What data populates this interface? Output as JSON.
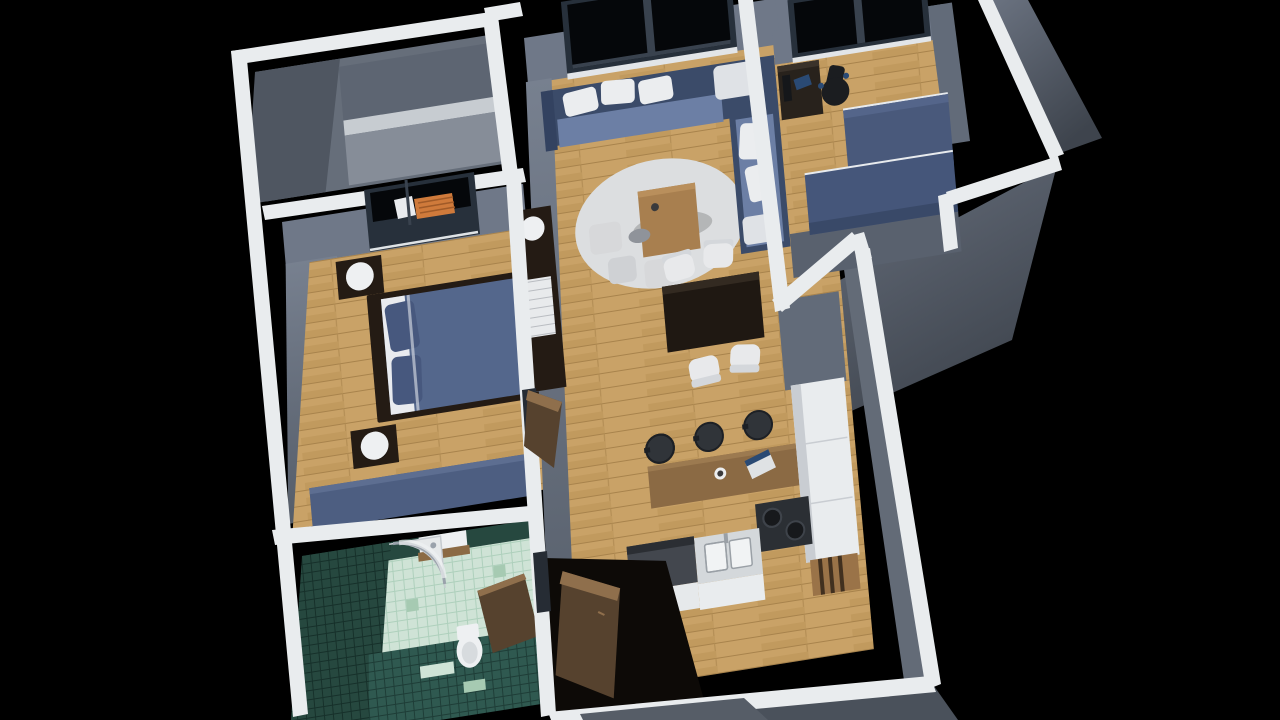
{
  "meta": {
    "description": "3D dollhouse-style architectural render of a one-bedroom apartment floor plan on a black background",
    "view": "isometric-top-down",
    "background": "#000000"
  },
  "scene": {
    "rooms": [
      {
        "id": "balcony",
        "name": "balcony"
      },
      {
        "id": "bedroom",
        "name": "bedroom"
      },
      {
        "id": "bathroom",
        "name": "bathroom"
      },
      {
        "id": "living-dining",
        "name": "living-dining-room"
      },
      {
        "id": "kitchen",
        "name": "kitchen"
      },
      {
        "id": "office",
        "name": "office"
      }
    ],
    "furniture": [
      "double-bed",
      "nightstand-lamps",
      "wardrobe-sideboard",
      "shelving-unit",
      "corner-sofa",
      "coffee-table",
      "rug",
      "poufs",
      "dining-table",
      "dining-chairs",
      "breakfast-bar",
      "bar-stools",
      "laptop",
      "kitchen-counters",
      "sink",
      "stove",
      "tall-cabinet",
      "shower",
      "toilet",
      "radiator",
      "desk",
      "office-chair",
      "cabinets",
      "entry-door"
    ]
  },
  "palette": {
    "background": "#000000",
    "wall_cut": "#e9ecee",
    "wall_cut_shade": "#dfe3e6",
    "wall_face": "#6f7888",
    "wall_face_mid": "#626b79",
    "wall_face_dark": "#59616e",
    "outer_face": "#565e6a",
    "balcony_floor": "#666e7a",
    "balcony_shade": "#4f5661",
    "balcony_upper": "#5d6572",
    "parapet_top": "#c7ccd1",
    "parapet_face": "#868d98",
    "wood": "#c9a267",
    "wood_line": "#a8834c",
    "window_frame": "#27303b",
    "window_divider": "#39424e",
    "glass": "#05070a",
    "sill": "#e2e5e8",
    "radiator": "#cf7a3b",
    "radiator_slat": "#a05a28",
    "white_pane": "#e9ebee",
    "espresso": "#241b14",
    "bed_cover": "#54678c",
    "pillow_navy": "#47587e",
    "sheet_white": "#e9ebef",
    "lamp": "#eef0f2",
    "navy_sideboard": "#4d5e81",
    "navy_sideboard_top": "#5d6e91",
    "drawer_white": "#e8eaec",
    "sofa_base": "#3b4b69",
    "sofa_seat": "#6c7fa5",
    "sofa_arm": "#334260",
    "pillow_white": "#ebedef",
    "cushion_soft": "#dfe2e6",
    "rug": "#dcdee0",
    "pouf": "#d7d8da",
    "pouf_dim": "#cfd1d4",
    "cushion_gray": "#8f939a",
    "coffee_table": "#a87f4f",
    "coffee_table_edge": "#b98f5c",
    "dining_table": "#1f1812",
    "dining_table_sheen": "#332a21",
    "chair_white": "#e8e9eb",
    "chair_white_shade": "#d4d7db",
    "stool": "#303439",
    "stool_rim": "#1d2025",
    "bar_wood": "#8b6a44",
    "bar_wood_edge": "#9c7a50",
    "laptop_body": "#dfe2e4",
    "laptop_screen": "#2a4a74",
    "cup": "#eceeef",
    "cup_inner": "#3a3a3c",
    "counter_dark": "#43474e",
    "counter_dark_top": "#2b2e33",
    "counter_light": "#d4d8db",
    "counter_front": "#e6e9eb",
    "counter_white": "#e9ecee",
    "counter_seam": "#c9cdd2",
    "sink_white": "#f1f3f4",
    "sink_stroke": "#9aa0a6",
    "stove_dark": "#2b2f34",
    "burner": "#17191c",
    "burner_rim": "#3e434a",
    "shelf_wood": "#9a7348",
    "shelf_slat": "#41301f",
    "tile_dark": "#26483f",
    "tile_dark_line": "#16302a",
    "tile_mid": "#2f5950",
    "tile_light": "#cfe3d6",
    "tile_light_line": "#aed0bc",
    "tile_accent": "#a6cab2",
    "shower_tray": "#e6e9ea",
    "chrome": "#9aa2ab",
    "glass_sheen": "#eef1f2",
    "toilet": "#eef0f2",
    "toilet_inner": "#d7dbde",
    "door_wood": "#56422e",
    "door_edge": "#8f6f4c",
    "door_gap": "#262c34",
    "entry_void": "#0d0a07",
    "step": "#565d67",
    "desk_dark": "#28221c",
    "desk_top": "#3a322a",
    "monitor": "#15171a",
    "chair_black": "#1b1d20",
    "office_cab": "#49597b",
    "office_cab_top": "#54658a",
    "office_cab_low": "#45567a",
    "office_cab_front": "#394968",
    "cab_edge_white": "#e8ebee",
    "picture_frame": "#20262e",
    "picture_inner": "#141920",
    "kitchen_east_inner": "#636b77",
    "bottom_face": "#4a515b"
  }
}
